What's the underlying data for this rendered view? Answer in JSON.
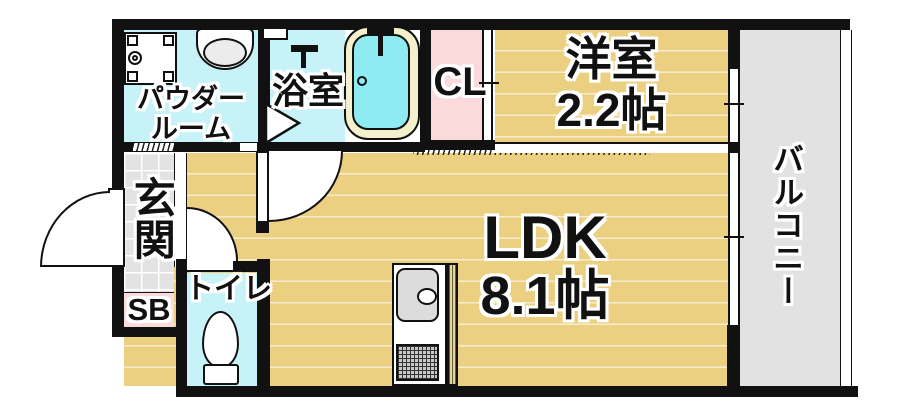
{
  "title": "1K floor plan",
  "colors": {
    "wall": "#111111",
    "floor_tan": "#ecd082",
    "room_cyan": "#c7f2f7",
    "tub_water": "#8febf2",
    "tub_rim": "#f4efcc",
    "pink": "#fbdadc",
    "tile_gray": "#e3e3e3",
    "balcony_gray": "#e2e2e2",
    "fixture_gray": "#dcdcdc"
  },
  "rooms": {
    "powder_room": {
      "label_line1": "パウダー",
      "label_line2": "ルーム"
    },
    "bathroom": {
      "label": "浴室"
    },
    "closet": {
      "label": "CL"
    },
    "western_room": {
      "label": "洋室",
      "size": "2.2帖"
    },
    "balcony": {
      "label": "バルコニー"
    },
    "entrance": {
      "label": "玄関"
    },
    "shoe_box": {
      "label": "SB"
    },
    "toilet": {
      "label": "トイレ"
    },
    "ldk": {
      "label": "LDK",
      "size": "8.1帖"
    }
  }
}
